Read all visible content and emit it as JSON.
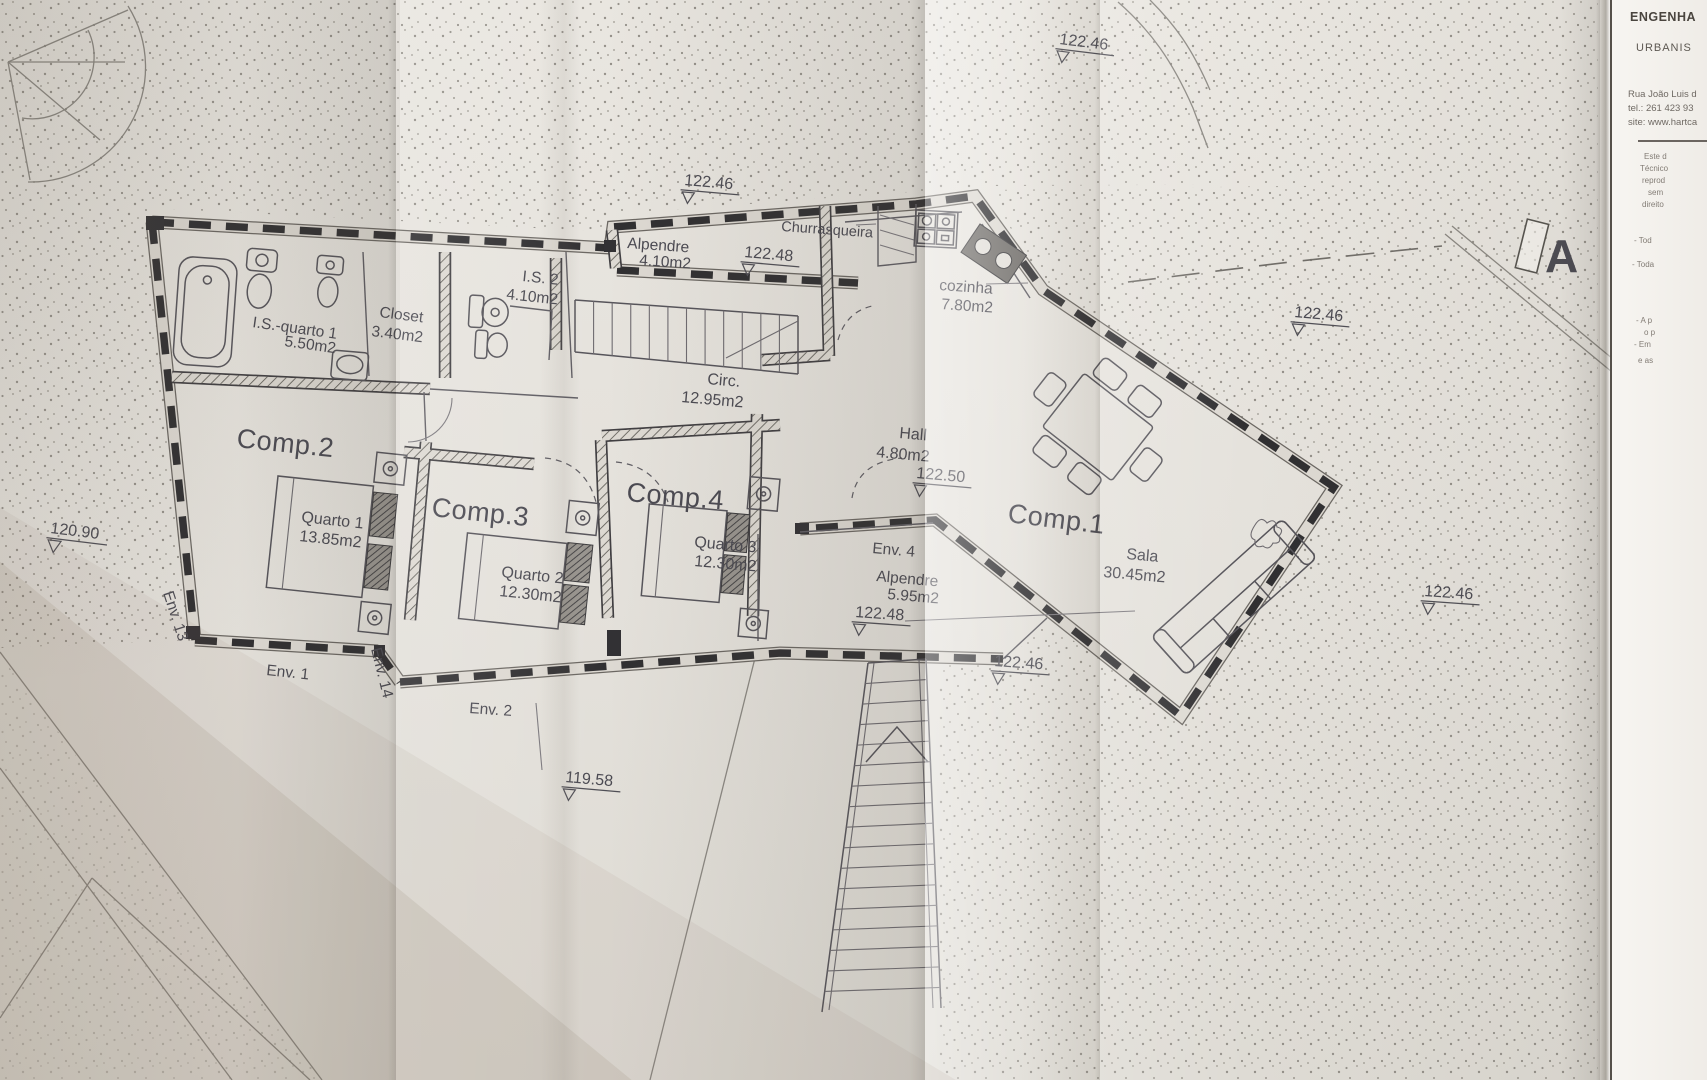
{
  "title_block": {
    "company_line1": "ENGENHA",
    "company_line2": "URBANIS",
    "address": "Rua João Luis d",
    "phone": "tel.: 261 423 93",
    "website": "site: www.hartca",
    "notes": [
      "Este d",
      "Técnico",
      "reprod",
      "sem",
      "direito",
      "- Tod",
      "- Toda",
      "- A p",
      "o p",
      "- Em",
      "e as"
    ]
  },
  "section_marker": {
    "label": "A"
  },
  "rooms": {
    "comp1": {
      "label": "Comp.1",
      "name": "Sala",
      "area": "30.45m2"
    },
    "comp2": {
      "label": "Comp.2",
      "name": "Quarto 1",
      "area": "13.85m2"
    },
    "comp3": {
      "label": "Comp.3",
      "name": "Quarto 2",
      "area": "12.30m2"
    },
    "comp4": {
      "label": "Comp.4",
      "name": "Quarto 3",
      "area": "12.30m2"
    },
    "is_quarto1": {
      "name": "I.S.-quarto 1",
      "area": "5.50m2"
    },
    "closet": {
      "name": "Closet",
      "area": "3.40m2"
    },
    "is2": {
      "name": "I.S. 2",
      "area": "4.10m2"
    },
    "alpendre_norte": {
      "name": "Alpendre",
      "area": "4.10m2"
    },
    "churrasqueira": {
      "name": "Churrasqueira"
    },
    "cozinha": {
      "name": "cozinha",
      "area": "7.80m2"
    },
    "circ": {
      "name": "Circ.",
      "area": "12.95m2"
    },
    "hall": {
      "name": "Hall",
      "area": "4.80m2"
    },
    "env4_alpendre": {
      "env": "Env. 4",
      "name": "Alpendre",
      "area": "5.95m2"
    }
  },
  "openings": {
    "env1": "Env. 1",
    "env2": "Env. 2",
    "env13": "Env. 13",
    "env14": "Env. 14"
  },
  "elevations": [
    {
      "location": "top-center",
      "value": "122.46"
    },
    {
      "location": "top-fold",
      "value": "122.46"
    },
    {
      "location": "alpendre-north",
      "value": "122.48"
    },
    {
      "location": "hall",
      "value": "122.50"
    },
    {
      "location": "right-mid",
      "value": "122.46"
    },
    {
      "location": "env4-porch",
      "value": "122.48"
    },
    {
      "location": "below-porch",
      "value": "122.46"
    },
    {
      "location": "bottom-right",
      "value": "122.46"
    },
    {
      "location": "left",
      "value": "120.90"
    },
    {
      "location": "bottom-center",
      "value": "119.58"
    }
  ]
}
